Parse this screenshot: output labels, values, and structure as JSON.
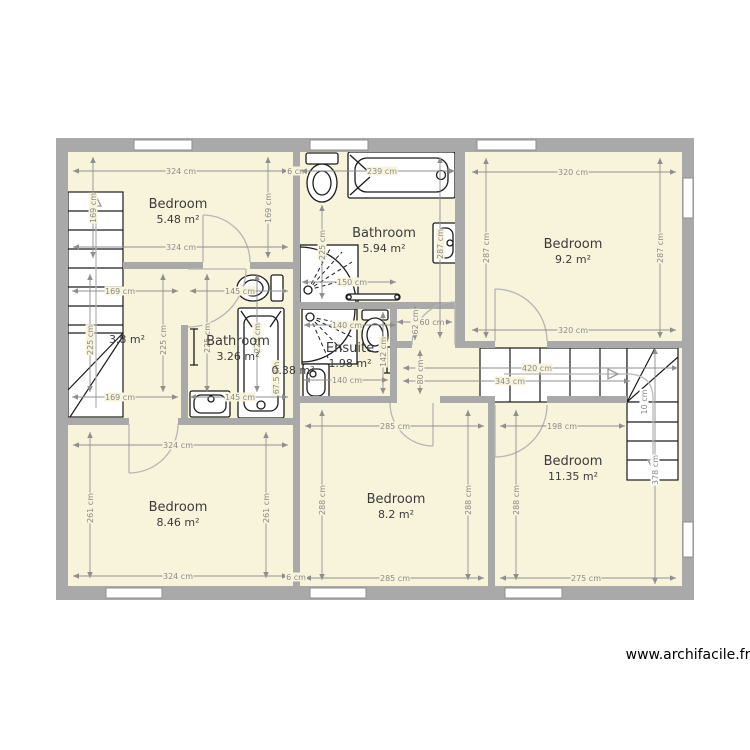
{
  "meta": {
    "watermark": "www.archifacile.fr"
  },
  "colors": {
    "wall": "#a9a9a9",
    "floor": "#f8f4dc",
    "dim": "#8f8f8f",
    "fixture": "#1c1c1c",
    "door": "#b5b5b5",
    "guide": "#b8b8b8",
    "label": "#3a3a3a"
  },
  "rooms": [
    {
      "name": "Bedroom",
      "area": "5.48 m²",
      "x": 178,
      "y": 208
    },
    {
      "name": "Bathroom",
      "area": "5.94 m²",
      "x": 384,
      "y": 237
    },
    {
      "name": "Bedroom",
      "area": "9.2 m²",
      "x": 573,
      "y": 248
    },
    {
      "name": "",
      "area": "3.8 m²",
      "x": 127,
      "y": 343
    },
    {
      "name": "Bathroom",
      "area": "3.26 m²",
      "x": 238,
      "y": 345
    },
    {
      "name": "",
      "area": "0.38 m²",
      "x": 293,
      "y": 374
    },
    {
      "name": "Ensuite",
      "area": "1.98 m²",
      "x": 350,
      "y": 352
    },
    {
      "name": "Bedroom",
      "area": "8.46 m²",
      "x": 178,
      "y": 511
    },
    {
      "name": "Bedroom",
      "area": "8.2 m²",
      "x": 396,
      "y": 503
    },
    {
      "name": "Bedroom",
      "area": "11.35 m²",
      "x": 573,
      "y": 465
    }
  ],
  "dimensions": [
    {
      "t": "h",
      "x1": 73,
      "x2": 288,
      "y": 171,
      "l": "324 cm",
      "lx": 181
    },
    {
      "t": "h",
      "x1": 73,
      "x2": 288,
      "y": 247,
      "l": "324 cm",
      "lx": 181
    },
    {
      "t": "t",
      "x": 297,
      "y": 171,
      "l": "6 cm",
      "rot": 0
    },
    {
      "t": "h",
      "x1": 301,
      "x2": 455,
      "y": 171,
      "l": "239 cm",
      "lx": 382
    },
    {
      "t": "h",
      "x1": 472,
      "x2": 676,
      "y": 172,
      "l": "320 cm",
      "lx": 573
    },
    {
      "t": "h",
      "x1": 472,
      "x2": 676,
      "y": 330,
      "l": "320 cm",
      "lx": 573
    },
    {
      "t": "h",
      "x1": 302,
      "x2": 396,
      "y": 282,
      "l": "150 cm",
      "lx": 352
    },
    {
      "t": "h",
      "x1": 304,
      "x2": 396,
      "y": 325,
      "l": "140 cm",
      "lx": 347
    },
    {
      "t": "h",
      "x1": 72,
      "x2": 178,
      "y": 291,
      "l": "169 cm",
      "lx": 120
    },
    {
      "t": "h",
      "x1": 190,
      "x2": 288,
      "y": 291,
      "l": "145 cm",
      "lx": 240
    },
    {
      "t": "h",
      "x1": 72,
      "x2": 178,
      "y": 397,
      "l": "169 cm",
      "lx": 120
    },
    {
      "t": "h",
      "x1": 190,
      "x2": 288,
      "y": 397,
      "l": "145 cm",
      "lx": 240
    },
    {
      "t": "h",
      "x1": 304,
      "x2": 388,
      "y": 380,
      "l": "140 cm",
      "lx": 347
    },
    {
      "t": "h",
      "x1": 397,
      "x2": 452,
      "y": 322,
      "l": "60 cm",
      "lx": 432
    },
    {
      "t": "h",
      "x1": 403,
      "x2": 678,
      "y": 368,
      "l": "420 cm",
      "lx": 537
    },
    {
      "t": "h",
      "x1": 403,
      "x2": 630,
      "y": 381,
      "l": "343 cm",
      "lx": 510
    },
    {
      "t": "h",
      "x1": 305,
      "x2": 484,
      "y": 426,
      "l": "285 cm",
      "lx": 395
    },
    {
      "t": "h",
      "x1": 305,
      "x2": 484,
      "y": 578,
      "l": "285 cm",
      "lx": 395
    },
    {
      "t": "h",
      "x1": 500,
      "x2": 625,
      "y": 426,
      "l": "198 cm",
      "lx": 562
    },
    {
      "t": "h",
      "x1": 500,
      "x2": 676,
      "y": 578,
      "l": "275 cm",
      "lx": 586
    },
    {
      "t": "h",
      "x1": 73,
      "x2": 288,
      "y": 445,
      "l": "324 cm",
      "lx": 178
    },
    {
      "t": "h",
      "x1": 73,
      "x2": 288,
      "y": 576,
      "l": "324 cm",
      "lx": 178
    },
    {
      "t": "t",
      "x": 296,
      "y": 577,
      "l": "6 cm",
      "rot": 0
    },
    {
      "t": "v",
      "y1": 157,
      "y2": 258,
      "x": 93,
      "l": "169 cm",
      "ly": 208
    },
    {
      "t": "v",
      "y1": 157,
      "y2": 258,
      "x": 268,
      "l": "169 cm",
      "ly": 208
    },
    {
      "t": "v",
      "y1": 205,
      "y2": 299,
      "x": 322,
      "l": "225 cm",
      "ly": 245
    },
    {
      "t": "v",
      "y1": 157,
      "y2": 338,
      "x": 440,
      "l": "287 cm",
      "ly": 244
    },
    {
      "t": "v",
      "y1": 158,
      "y2": 338,
      "x": 486,
      "l": "287 cm",
      "ly": 248
    },
    {
      "t": "v",
      "y1": 158,
      "y2": 338,
      "x": 660,
      "l": "287 cm",
      "ly": 248
    },
    {
      "t": "v",
      "y1": 274,
      "y2": 392,
      "x": 90,
      "l": "225 cm",
      "ly": 340
    },
    {
      "t": "v",
      "y1": 274,
      "y2": 392,
      "x": 163,
      "l": "225 cm",
      "ly": 340
    },
    {
      "t": "v",
      "y1": 274,
      "y2": 392,
      "x": 207,
      "l": "225 cm",
      "ly": 338
    },
    {
      "t": "v",
      "y1": 274,
      "y2": 392,
      "x": 257,
      "l": "225 cm",
      "ly": 338
    },
    {
      "t": "v",
      "y1": 312,
      "y2": 394,
      "x": 383,
      "l": "142 cm",
      "ly": 352
    },
    {
      "t": "v",
      "y1": 306,
      "y2": 340,
      "x": 415,
      "l": "62 cm",
      "ly": 322
    },
    {
      "t": "v",
      "y1": 350,
      "y2": 394,
      "x": 420,
      "l": "80 cm",
      "ly": 372
    },
    {
      "t": "v",
      "y1": 348,
      "y2": 584,
      "x": 655,
      "l": "378 cm",
      "ly": 470,
      "w": 1
    },
    {
      "t": "v",
      "y1": 410,
      "y2": 580,
      "x": 516,
      "l": "288 cm",
      "ly": 500
    },
    {
      "t": "v",
      "y1": 410,
      "y2": 580,
      "x": 322,
      "l": "288 cm",
      "ly": 500
    },
    {
      "t": "v",
      "y1": 410,
      "y2": 580,
      "x": 468,
      "l": "288 cm",
      "ly": 500
    },
    {
      "t": "v",
      "y1": 432,
      "y2": 578,
      "x": 90,
      "l": "261 cm",
      "ly": 508
    },
    {
      "t": "v",
      "y1": 432,
      "y2": 578,
      "x": 266,
      "l": "261 cm",
      "ly": 508
    },
    {
      "t": "t",
      "x": 276,
      "y": 378,
      "l": "67.5 cm",
      "rot": 1
    },
    {
      "t": "t",
      "x": 644,
      "y": 402,
      "l": "10 cm",
      "rot": 1,
      "w": 1
    }
  ]
}
